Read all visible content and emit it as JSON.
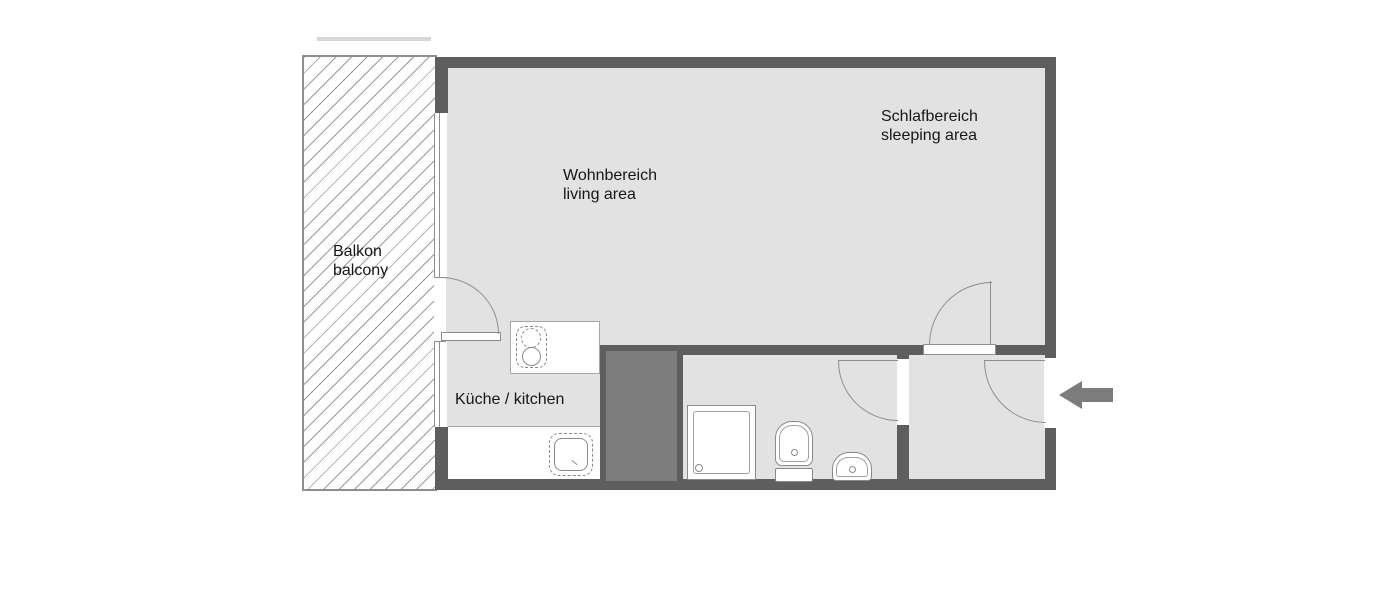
{
  "plan": {
    "rooms": {
      "balcony": {
        "name_de": "Balkon",
        "name_en": "balcony"
      },
      "living": {
        "name_de": "Wohnbereich",
        "name_en": "living area"
      },
      "sleeping": {
        "name_de": "Schlafbereich",
        "name_en": "sleeping area"
      },
      "kitchen": {
        "name": "Küche / kitchen"
      }
    },
    "icons": {
      "entrance_arrow": "entrance-arrow",
      "doors": [
        "balcony-door-swing",
        "room-hall-door-swing",
        "bathroom-door-swing",
        "entrance-door-swing"
      ],
      "fixtures": [
        "stove",
        "kitchen-sink",
        "shower",
        "toilet",
        "washbasin",
        "shaft"
      ]
    },
    "colors": {
      "wall": "#5e5e5e",
      "floor": "#e2e2e2",
      "shaft": "#7d7d7d",
      "arrow": "#7c7c7c",
      "hatch_line": "#9a9a9a",
      "fixture_line": "#8a8a8a",
      "text": "#161616"
    }
  }
}
